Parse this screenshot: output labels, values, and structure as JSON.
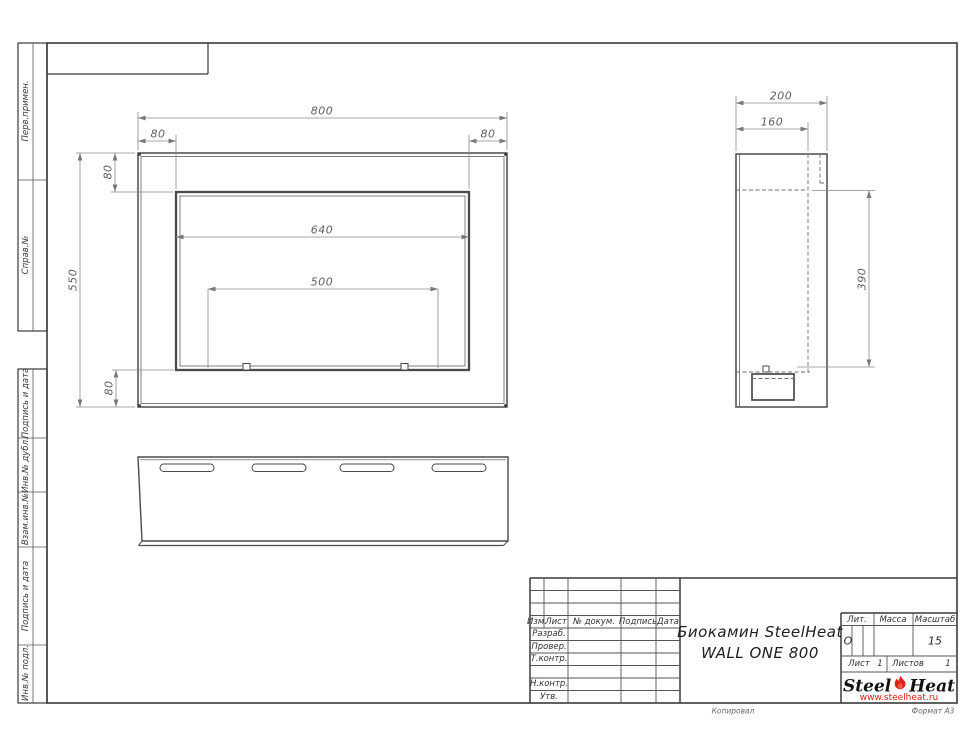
{
  "sheet": {
    "side_labels": [
      "Перв.примен.",
      "Справ.№",
      "Подпись и дата",
      "Инв.№ дубл.",
      "Взам.инв.№",
      "Подпись и дата",
      "Инв.№ подл."
    ]
  },
  "views": {
    "front": {
      "dims": {
        "overall_width": "800",
        "top_left_flange": "80",
        "top_right_flange": "80",
        "top_flange": "80",
        "opening_width": "640",
        "burner_span": "500",
        "overall_height": "550",
        "bottom_flange": "80"
      }
    },
    "side": {
      "dims": {
        "depth": "200",
        "inner_depth": "160",
        "opening_height": "390"
      }
    }
  },
  "title_block": {
    "headers": {
      "izm": "Изм.",
      "list": "Лист",
      "doc": "№ докум.",
      "sign": "Подпись",
      "date": "Дата"
    },
    "roles": {
      "razrab": "Разраб.",
      "prover": "Провер.",
      "tkontr": "Т.контр.",
      "nkontr": "Н.контр.",
      "utv": "Утв."
    },
    "title_line1": "Биокамин SteelHeat",
    "title_line2": "WALL ONE 800",
    "lit_header": "Лит.",
    "massa_header": "Масса",
    "masshtab_header": "Масштаб",
    "lit_value": "О",
    "masshtab_value": "15",
    "sheet_label": "Лист",
    "sheet_value": "1",
    "sheets_label": "Листов",
    "sheets_value": "1",
    "logo": {
      "part1": "Steel",
      "part2": "Heat",
      "url": "www.steelheat.ru"
    },
    "footer": {
      "copied": "Копировал",
      "format": "Формат А3"
    }
  },
  "colors": {
    "accent_red": "#d42411",
    "line_dark": "#3a3a3a",
    "line_dim": "#8a8a8a"
  }
}
